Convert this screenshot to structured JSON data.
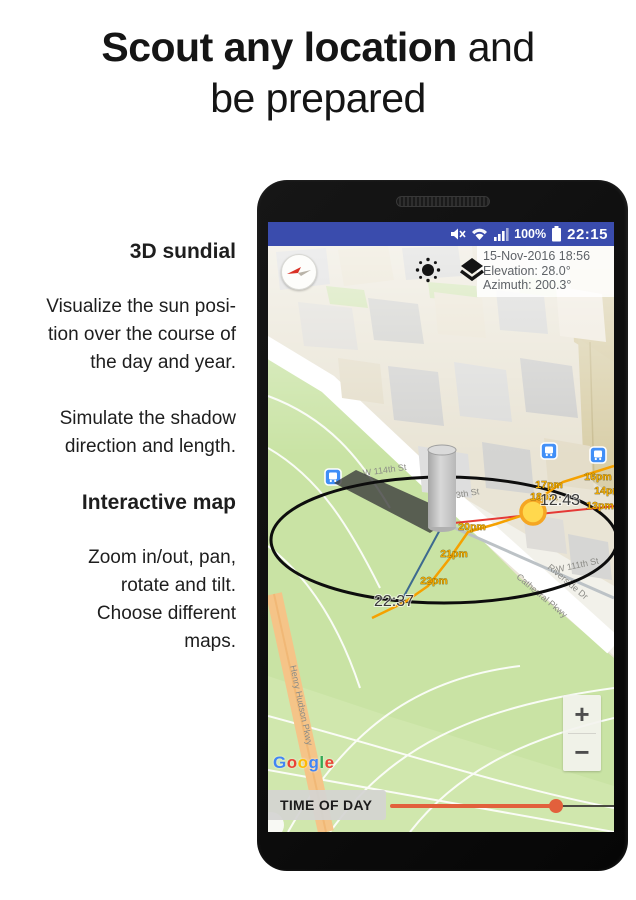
{
  "headline": {
    "bold": "Scout any location",
    "suffix": " and",
    "line2": "be prepared"
  },
  "features": {
    "sundial_title": "3D sundial",
    "sundial_p": [
      "Visualize the sun posi-",
      "tion over the course of",
      "the day and year."
    ],
    "shadow_p": [
      "Simulate the shadow",
      "direction and length."
    ],
    "map_title": "Interactive map",
    "map_p": [
      "Zoom in/out, pan,",
      "rotate and tilt.",
      "Choose different",
      "maps."
    ]
  },
  "status_bar": {
    "icons": [
      "volume-mute",
      "wifi",
      "signal-strength",
      "battery-full"
    ],
    "battery": "100%",
    "time": "22:15",
    "bg_color": "#3a4cad"
  },
  "info_panel": {
    "datetime": "15-Nov-2016 18:56",
    "elevation": "Elevation: 28.0°",
    "azimuth": "Azimuth: 200.3°"
  },
  "map": {
    "streets": [
      "W 114th St",
      "W 113th St",
      "W 111th St",
      "Riverside Dr",
      "Cathedral Pkwy",
      "Henry Hudson Pkwy"
    ],
    "attribution_letters": [
      "G",
      "o",
      "o",
      "g",
      "l",
      "e"
    ],
    "attribution_styles": [
      "color:#4285F4",
      "color:#EA4335",
      "color:#FBBC05",
      "color:#4285F4",
      "color:#34A853",
      "color:#EA4335"
    ],
    "zoom_in": "+",
    "zoom_out": "−",
    "park_color": "#c9e3a4"
  },
  "sundial": {
    "time_labels": [
      "13pm",
      "14pm",
      "16pm",
      "17pm",
      "18pm",
      "20pm",
      "21pm",
      "22pm"
    ],
    "noon_time": "12:43",
    "end_time": "22:37",
    "sun_color": "#ffd84d",
    "sun_border_color": "#f5a623",
    "path_color": "#f5a100",
    "direction_line_color": "#e53935",
    "shadow_line_color": "#3d6a8f"
  },
  "controls": {
    "time_of_day": "TIME OF DAY",
    "slider_fraction": 0.74,
    "slider_color": "#e2603c"
  }
}
